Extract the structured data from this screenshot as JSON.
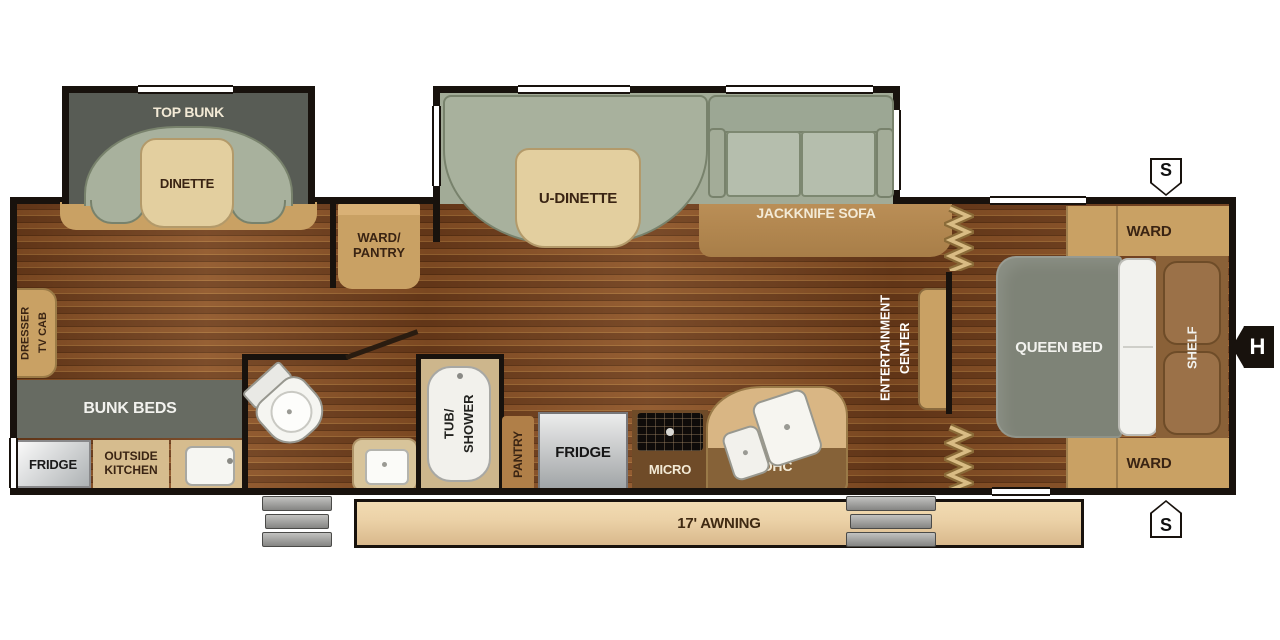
{
  "colors": {
    "wall": "#18120d",
    "ink": "#3a2413",
    "cream": "#f3ead6",
    "wood-a": "#8a5126",
    "wood-b": "#6d3c1b",
    "sage": "#a8b19d",
    "sage-dk": "#78826c",
    "sage-lt": "#b5bead",
    "tan": "#c9a164",
    "tan-lt": "#e3cf9f",
    "tan-dk": "#8a6239",
    "band": "#b68a52",
    "gray-slide": "#585c55",
    "gray-bunks": "#676b62",
    "bed": "#7e8377",
    "awning": "#ecd2a8",
    "gold": "#b08e52"
  },
  "slideout_front": {
    "bunk_label": "TOP BUNK",
    "table_label": "DINETTE"
  },
  "slideout_main": {
    "table_label": "U-DINETTE",
    "sofa_label": "JACKKNIFE SOFA"
  },
  "closets": {
    "ward_pantry_line1": "WARD/",
    "ward_pantry_line2": "PANTRY",
    "ward_top": "WARD",
    "ward_bottom": "WARD"
  },
  "left_side": {
    "dresser_line1": "DRESSER",
    "dresser_line2": "TV CAB",
    "bunk_beds": "BUNK BEDS",
    "fridge": "FRIDGE",
    "outside_kitchen_line1": "OUTSIDE",
    "outside_kitchen_line2": "KITCHEN"
  },
  "bathroom": {
    "tub_line1": "TUB/",
    "tub_line2": "SHOWER"
  },
  "kitchen": {
    "pantry": "PANTRY",
    "fridge": "FRIDGE",
    "micro": "MICRO",
    "ohc": "OHC"
  },
  "living": {
    "entertainment_line1": "ENTERTAINMENT",
    "entertainment_line2": "CENTER"
  },
  "bedroom": {
    "bed": "QUEEN BED",
    "shelf": "SHELF"
  },
  "exterior": {
    "awning": "17' AWNING",
    "hitch": "H",
    "stabilizer_top": "S",
    "stabilizer_bottom": "S"
  }
}
